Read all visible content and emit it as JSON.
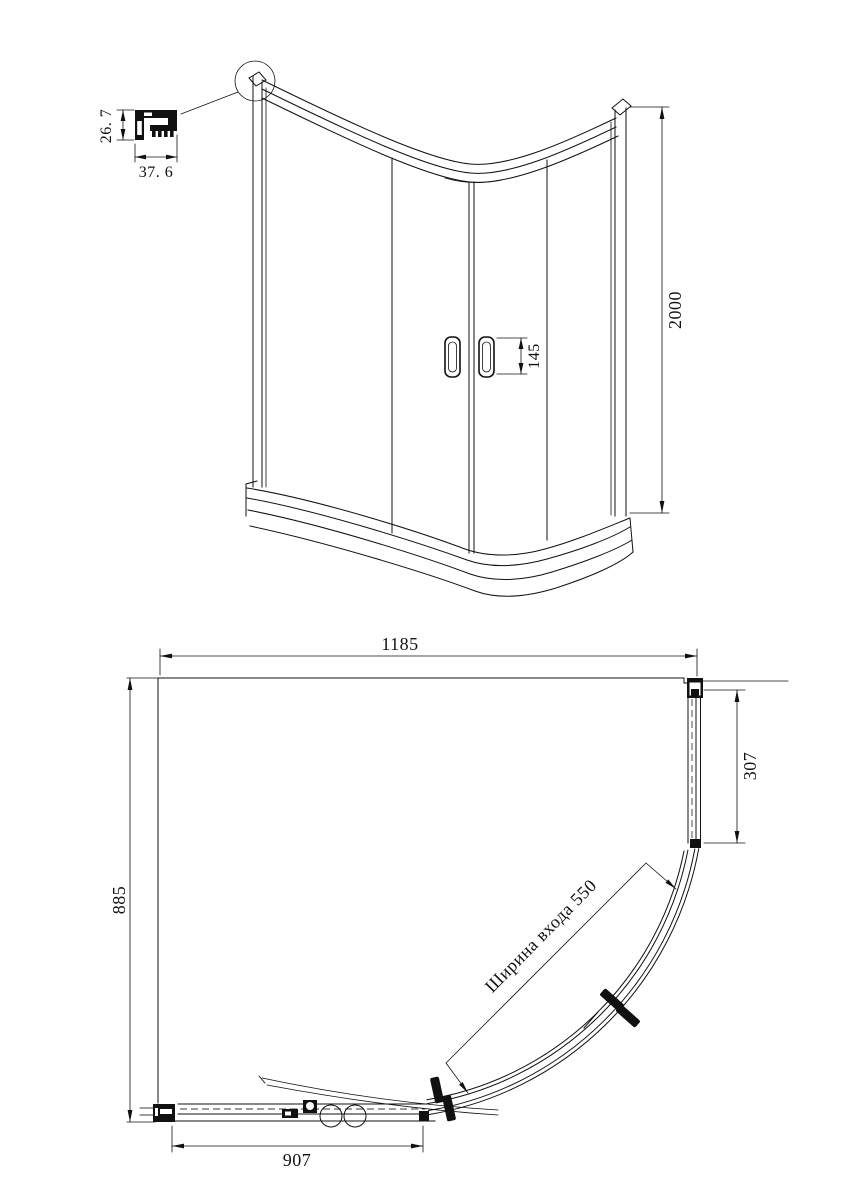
{
  "document": {
    "type": "shower-enclosure-technical-drawing",
    "colors": {
      "line": "#111111",
      "background": "#ffffff"
    },
    "views": {
      "elevation": {
        "profile_detail": {
          "height_mm": "26. 7",
          "width_mm": "37. 6"
        },
        "overall_height_mm": "2000",
        "handle_height_mm": "145"
      },
      "plan": {
        "overall_width_mm": "1185",
        "overall_depth_mm": "885",
        "side_fixed_panel_mm": "307",
        "front_fixed_panel_mm": "907",
        "entrance_width_label": "Ширина входа 550"
      }
    }
  }
}
